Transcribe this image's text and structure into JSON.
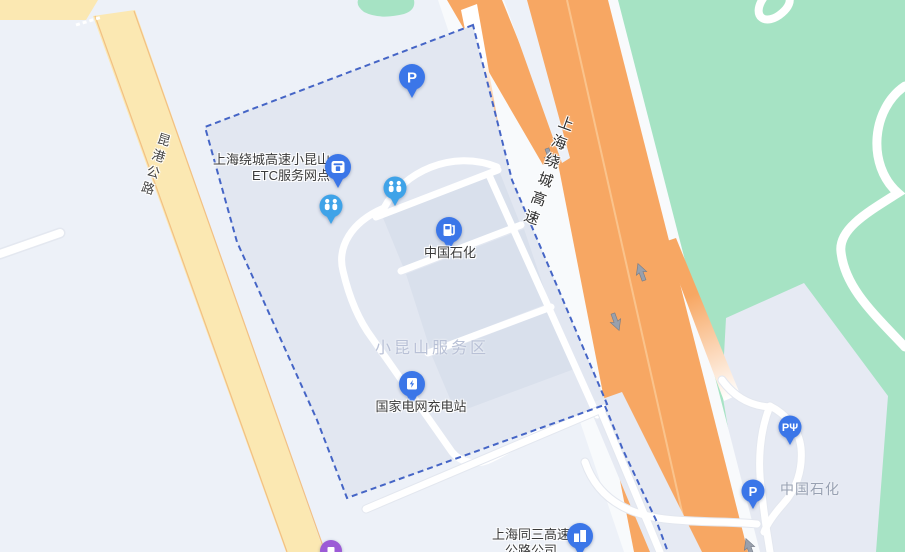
{
  "map": {
    "colors": {
      "background": "#EDF1F8",
      "highway_orange": "#F7A763",
      "local_road_yellow": "#FBE8B2",
      "greenery_green": "#A6E3C4",
      "service_area_fill": "#E2E7F1",
      "boundary_dash_blue": "#4565C6",
      "poi_pin_blue": "#3B76E8",
      "restroom_pin_blue": "#3FA3E8",
      "transit_pin_purple": "#9C5BD6"
    },
    "road_labels": {
      "ring_expressway": "上海绕城高速",
      "kungang_highway": "昆港公路"
    },
    "area_labels": {
      "service_area": "小昆山服务区",
      "sinopec_area": "中国石化"
    },
    "pois": {
      "etc_outlet": {
        "line1": "上海绕城高速小昆山",
        "line2": "ETC服务网点"
      },
      "sinopec_station": {
        "label": "中国石化"
      },
      "charging_station": {
        "label": "国家电网充电站"
      },
      "tongsan_company": {
        "line1": "上海同三高速",
        "line2": "公路公司"
      }
    },
    "icon_glyphs": {
      "parking": "P",
      "parking_fuel": "PΨ"
    }
  }
}
